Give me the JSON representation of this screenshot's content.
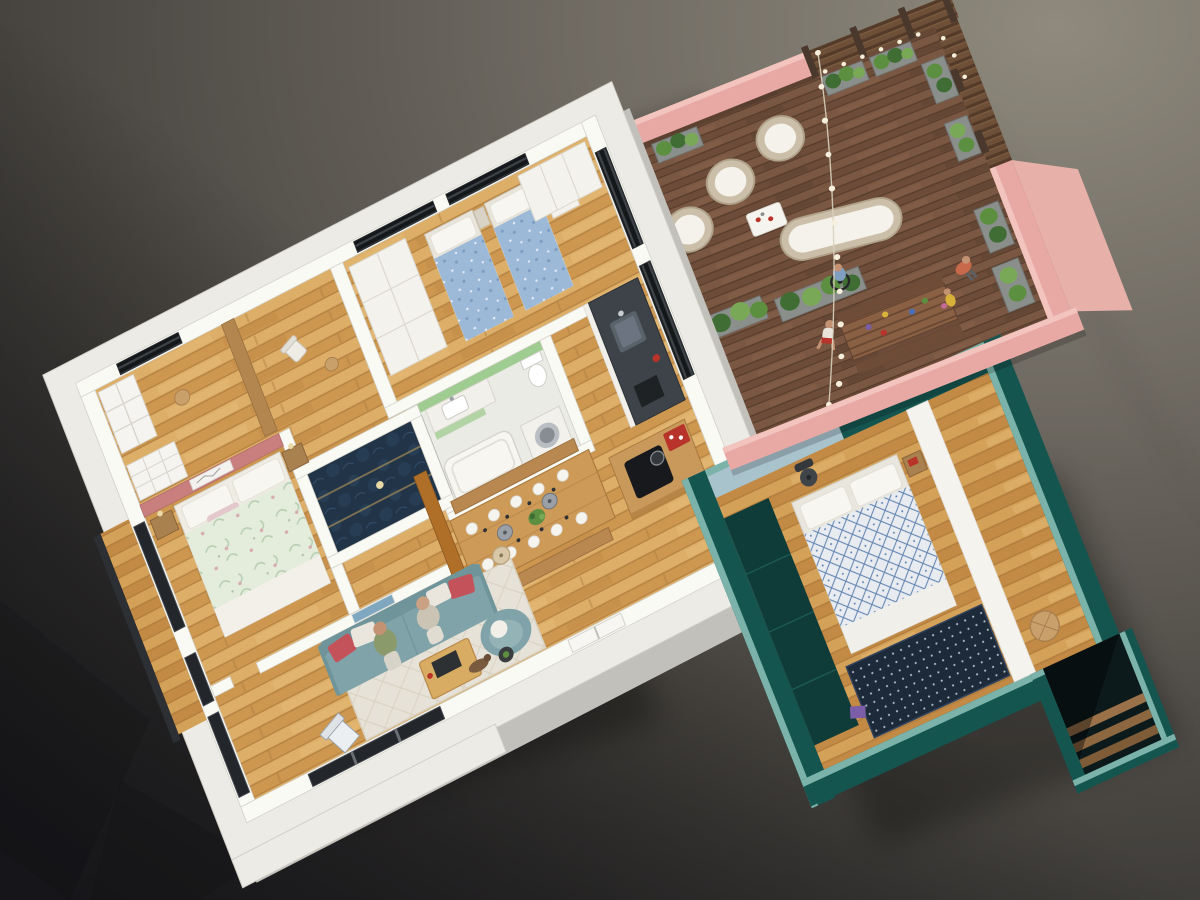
{
  "scene": {
    "type": "isometric-3d-floorplan-render",
    "areas": [
      "main-apartment",
      "roof-terrace",
      "annex-suite",
      "stairwell"
    ],
    "rooms": [
      "dressing-room",
      "study",
      "kids-bedroom",
      "kitchen",
      "bathroom",
      "walk-in-closet",
      "master-bedroom",
      "living-room",
      "dining-area",
      "balcony",
      "terrace-deck",
      "annex-bedroom"
    ],
    "people_count": 7
  },
  "palette": {
    "bg_light": "#8f8a7d",
    "bg_mid": "#6f6a62",
    "bg_dark": "#4a4742",
    "bg_corner": "#232327",
    "slab_top": "#edebe6",
    "slab_side": "#c2c0ba",
    "wall_white": "#fafaf5",
    "wall_stroke": "#d2d0c8",
    "wood_mid": "#cd9750",
    "wood_hi": "#dcae68",
    "wood_dark": "#a8763a",
    "wood_light": "#e5bc78",
    "wood2_mid": "#c28a44",
    "wood2_hi": "#d4a158",
    "deck_a": "#7a5742",
    "deck_b": "#6d4c39",
    "deck_line": "#563c2c",
    "pink": "#e8a9a4",
    "pink_light": "#f2c4bd",
    "pink_dark": "#d48e89",
    "pink_face": "#e7b0a9",
    "rose": "#c97f7e",
    "tan": "#b3864f",
    "amber": "#b06f28",
    "navy": "#223448",
    "navy_hi": "#2c4862",
    "gold": "#b99a58",
    "green_bath": "#9fcc90",
    "tile": "#e9ebe4",
    "counter_dark": "#3d4349",
    "island_wood": "#c9995c",
    "table_wood": "#cd9a58",
    "bench_wood": "#b98850",
    "sofa": "#7fa3a8",
    "sofa_dark": "#6f9499",
    "rug": "#e7e2d7",
    "rug_line": "#d9d2c2",
    "teal_dark": "#155550",
    "teal_cut": "#7bb3aa",
    "teal_deep": "#0f3b38",
    "powder": "#a9c3cd",
    "kids_blue": "#9db9d8",
    "kids_blue_dark": "#7c9cc2",
    "floral_base": "#e4ecdb",
    "floral_leaf": "#b6cdb0",
    "floral_pink": "#d8a8b0",
    "diamond_base": "#e8ebef",
    "diamond_line": "#5b80b0",
    "annex_rug": "#1c2a3a",
    "fence_a": "#6e5038",
    "fence_b": "#533a29",
    "post": "#4a382c",
    "wicker": "#cbbfa9",
    "cushion": "#f4f2ea",
    "plant_a": "#3f6d33",
    "plant_b": "#5c8f3f",
    "plant_c": "#79a957",
    "trough": "#8a8f8c",
    "glass_dark": "#23262a",
    "frame_gray": "#454a4f",
    "bulb": "#f6efdc",
    "string_wire": "#d8d0bd",
    "skin": "#c29273",
    "accent_red": "#b8342a",
    "white_soft": "#f6f4ef"
  }
}
